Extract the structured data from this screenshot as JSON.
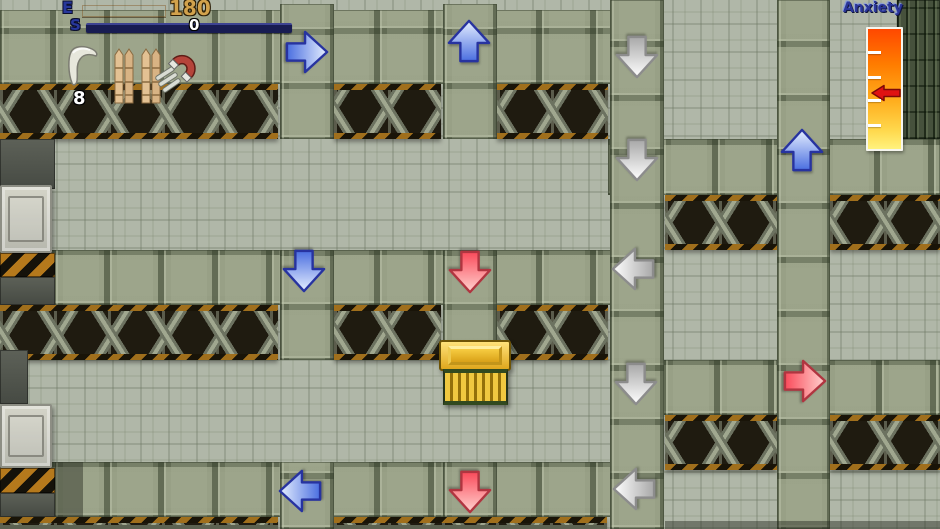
{
  "hud": {
    "energy_label": "E",
    "energy_value": "180",
    "stamina_label": "S",
    "stamina_value": "0",
    "inventory": {
      "boomerang_count": "8",
      "items": [
        "boomerang",
        "bamboo-spikes",
        "bamboo-spikes",
        "horseshoe-magnet"
      ]
    }
  },
  "gauge": {
    "label": "Anxiety",
    "tick_offsets": [
      22,
      47,
      70,
      95
    ],
    "marker": "red-left-arrow"
  },
  "map": {
    "chest": {
      "x": 437,
      "y": 338
    },
    "arrows": [
      {
        "direction": "right",
        "color": "blue",
        "x": 307,
        "y": 52
      },
      {
        "direction": "up",
        "color": "blue",
        "x": 469,
        "y": 41
      },
      {
        "direction": "down",
        "color": "gray",
        "x": 637,
        "y": 57
      },
      {
        "direction": "down",
        "color": "gray",
        "x": 637,
        "y": 160
      },
      {
        "direction": "up",
        "color": "blue",
        "x": 802,
        "y": 150
      },
      {
        "direction": "down",
        "color": "blue",
        "x": 304,
        "y": 271
      },
      {
        "direction": "down",
        "color": "red",
        "x": 470,
        "y": 272
      },
      {
        "direction": "left",
        "color": "gray",
        "x": 633,
        "y": 269
      },
      {
        "direction": "down",
        "color": "gray",
        "x": 636,
        "y": 384
      },
      {
        "direction": "right",
        "color": "red",
        "x": 805,
        "y": 381
      },
      {
        "direction": "left",
        "color": "blue",
        "x": 300,
        "y": 491
      },
      {
        "direction": "down",
        "color": "red",
        "x": 470,
        "y": 492
      },
      {
        "direction": "left",
        "color": "gray",
        "x": 634,
        "y": 489
      }
    ]
  },
  "colors": {
    "arrow_light_blue": "#e6efff",
    "arrow_dark_blue": "#4a6ee0",
    "arrow_stroke_blue": "#2733a0",
    "arrow_light_red": "#ffd2cf",
    "arrow_dark_red": "#fa4a5a",
    "arrow_stroke_red": "#b03540",
    "arrow_light_gray": "#ffffff",
    "arrow_dark_gray": "#a8a8a8",
    "arrow_stroke_gray": "#8c8c8c",
    "energy_bar_top": "#ffcf5a",
    "energy_bar_bottom": "#d97a07",
    "stamina_bar": "#181c52",
    "gauge_gradient_top": "#ff4800",
    "gauge_gradient_bottom": "#fff27e",
    "gauge_marker_red": "#e01212"
  }
}
